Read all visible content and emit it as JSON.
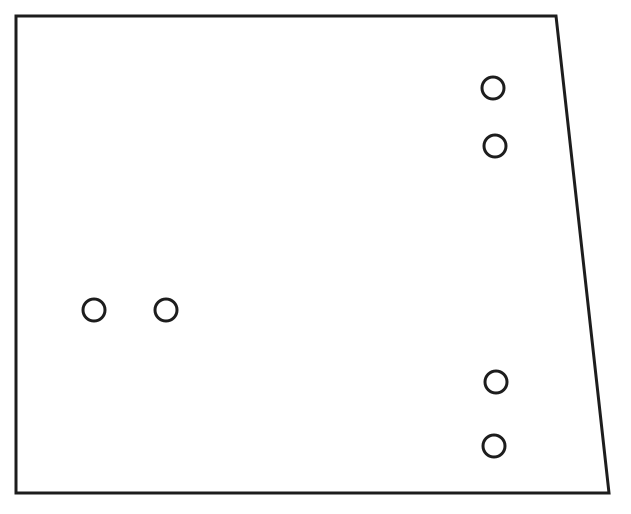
{
  "diagram": {
    "canvas": {
      "width": 631,
      "height": 514,
      "background_color": "#ffffff"
    },
    "line_color": "#1d1d1d",
    "panel_outline": {
      "points": [
        [
          16,
          16
        ],
        [
          556,
          16
        ],
        [
          609,
          493
        ],
        [
          16,
          493
        ]
      ],
      "stroke_width": 3,
      "fill": "#ffffff"
    },
    "holes": {
      "radius": 11,
      "stroke_width": 3,
      "fill": "#ffffff",
      "items": [
        {
          "cx": 493,
          "cy": 88
        },
        {
          "cx": 495,
          "cy": 146
        },
        {
          "cx": 94,
          "cy": 310
        },
        {
          "cx": 166,
          "cy": 310
        },
        {
          "cx": 496,
          "cy": 382
        },
        {
          "cx": 494,
          "cy": 446
        }
      ]
    }
  }
}
